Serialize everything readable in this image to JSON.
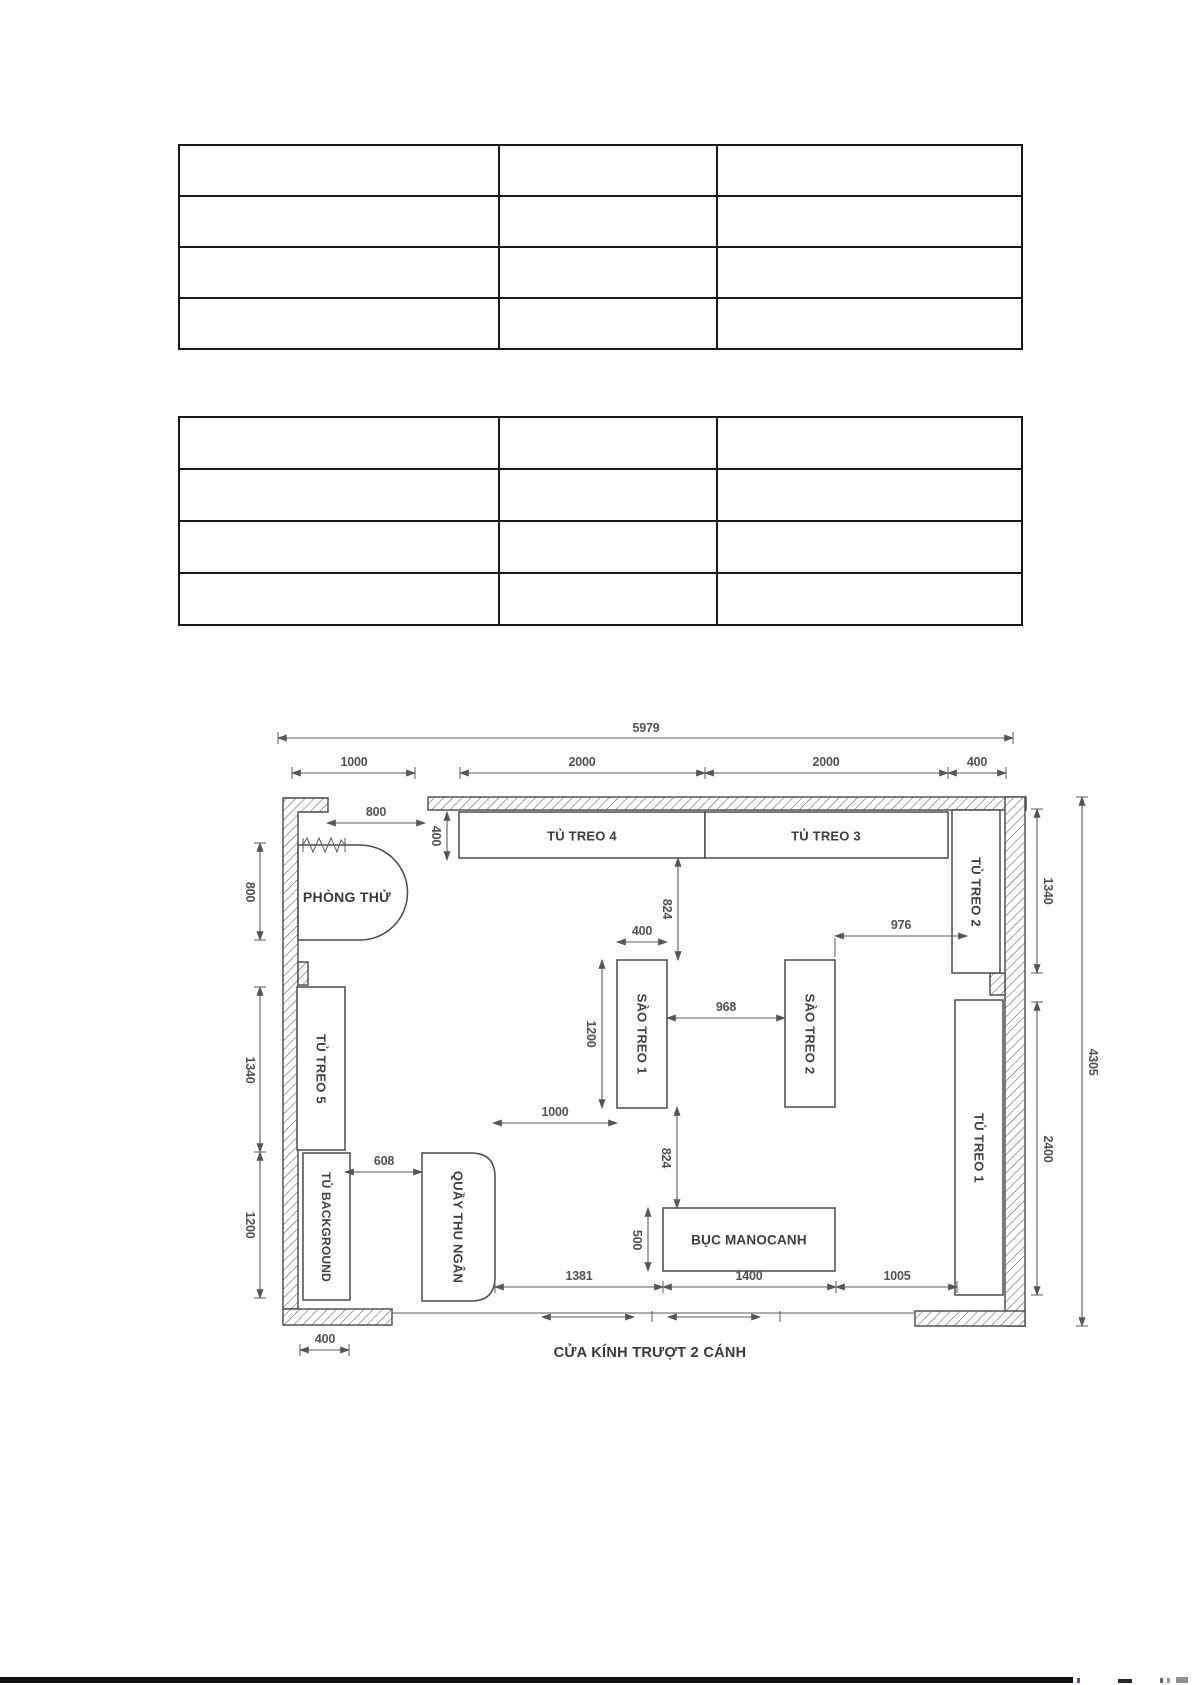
{
  "document": {
    "background": "#ffffff",
    "bottom_bar_color": "#111111"
  },
  "tables": {
    "table1": {
      "rows": 4,
      "columns": 3
    },
    "table2": {
      "rows": 4,
      "columns": 3
    }
  },
  "floor_plan": {
    "dims": {
      "total_width": "5979",
      "top_1000": "1000",
      "top_2000a": "2000",
      "top_2000b": "2000",
      "top_400": "400",
      "left_800": "800",
      "left_1340": "1340",
      "left_1200": "1200",
      "bottom_left_400": "400",
      "right_1340": "1340",
      "right_2400": "2400",
      "right_4305": "4305",
      "fit_800": "800",
      "cab_400": "400",
      "gap_824_upper": "824",
      "rail_400": "400",
      "rail_1200": "1200",
      "mid_968": "968",
      "mid_976": "976",
      "aisle_1000": "1000",
      "gap_824_lower": "824",
      "mid_608": "608",
      "podium_500": "500",
      "bot_1381": "1381",
      "bot_1400": "1400",
      "bot_1005": "1005"
    },
    "labels": {
      "tu_treo_4": "TỦ TREO 4",
      "tu_treo_3": "TỦ TREO 3",
      "tu_treo_2": "TỦ TREO 2",
      "tu_treo_1": "TỦ TREO 1",
      "tu_treo_5": "TỦ TREO 5",
      "tu_background": "TỦ BACKGROUND",
      "phong_thu": "PHÒNG THỬ",
      "quay_thu_ngan": "QUẦY THU NGÂN",
      "sao_treo_1": "SÀO TREO 1",
      "sao_treo_2": "SÀO TREO 2",
      "buc_manocanh": "BỤC MANOCANH",
      "sliding_door": "CỬA KÍNH TRƯỢT 2 CÁNH"
    }
  }
}
